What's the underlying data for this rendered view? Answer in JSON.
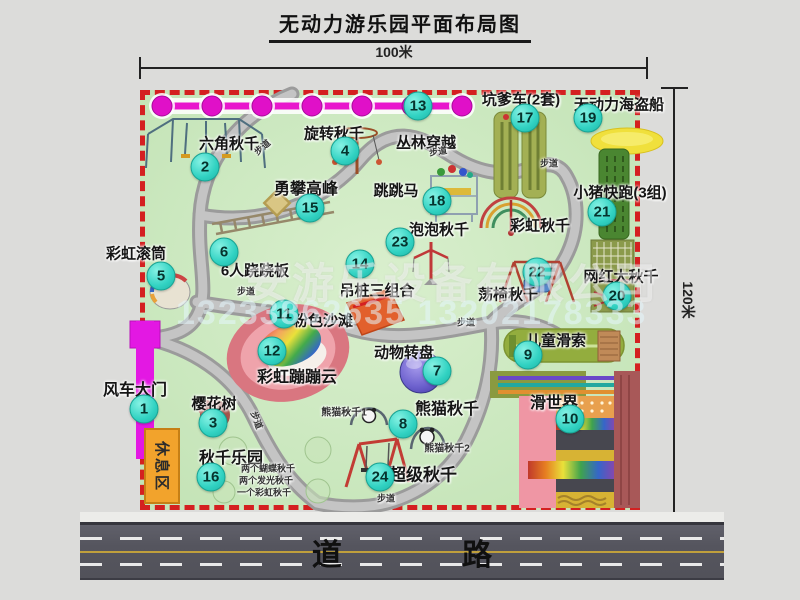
{
  "title": "无动力游乐园平面布局图",
  "dimensions": {
    "top": "100米",
    "right": "120米"
  },
  "road": {
    "label": "道 路"
  },
  "watermark": {
    "company": "安游乐设备有限公司",
    "phone": "13233862635 13202178333"
  },
  "rest_area": {
    "label": "休息区"
  },
  "items": [
    {
      "num": "1",
      "label": "风车大门",
      "lx": 135,
      "ly": 388,
      "cx": 144,
      "cy": 409,
      "ls": 16
    },
    {
      "num": "2",
      "label": "六角秋千",
      "lx": 229,
      "ly": 143,
      "cx": 205,
      "cy": 167
    },
    {
      "num": "3",
      "label": "樱花树",
      "lx": 214,
      "ly": 403,
      "cx": 213,
      "cy": 423
    },
    {
      "num": "4",
      "label": "旋转秋千",
      "lx": 334,
      "ly": 133,
      "cx": 345,
      "cy": 151
    },
    {
      "num": "5",
      "label": "彩虹滚筒",
      "lx": 136,
      "ly": 253,
      "cx": 161,
      "cy": 276
    },
    {
      "num": "6",
      "label": "6人跷跷板",
      "lx": 255,
      "ly": 270,
      "cx": 224,
      "cy": 252
    },
    {
      "num": "7",
      "label": "动物转盘",
      "lx": 404,
      "ly": 352,
      "cx": 437,
      "cy": 371
    },
    {
      "num": "8",
      "label": "熊猫秋千",
      "lx": 447,
      "ly": 407,
      "cx": 403,
      "cy": 424,
      "ls": 16
    },
    {
      "num": "9",
      "label": "儿童滑索",
      "lx": 556,
      "ly": 340,
      "cx": 528,
      "cy": 355
    },
    {
      "num": "10",
      "label": "滑世界",
      "lx": 554,
      "ly": 401,
      "cx": 570,
      "cy": 419,
      "ls": 16
    },
    {
      "num": "11",
      "label": "粉色沙滩",
      "lx": 323,
      "ly": 320,
      "cx": 284,
      "cy": 314
    },
    {
      "num": "12",
      "label": "彩虹蹦蹦云",
      "lx": 297,
      "ly": 375,
      "cx": 272,
      "cy": 351,
      "ls": 16
    },
    {
      "num": "13",
      "label": "丛林穿越",
      "lx": 426,
      "ly": 142,
      "cx": 418,
      "cy": 106
    },
    {
      "num": "14",
      "label": "吊桩三组合",
      "lx": 377,
      "ly": 290,
      "cx": 360,
      "cy": 264
    },
    {
      "num": "15",
      "label": "勇攀高峰",
      "lx": 306,
      "ly": 187,
      "cx": 310,
      "cy": 208,
      "ls": 16
    },
    {
      "num": "16",
      "label": "秋千乐园",
      "lx": 231,
      "ly": 456,
      "cx": 211,
      "cy": 477,
      "ls": 16
    },
    {
      "num": "17",
      "label": "坑爹车(2套)",
      "lx": 521,
      "ly": 99,
      "cx": 525,
      "cy": 118
    },
    {
      "num": "18",
      "label": "跳跳马",
      "lx": 396,
      "ly": 190,
      "cx": 437,
      "cy": 201
    },
    {
      "num": "19",
      "label": "无动力海盗船",
      "lx": 619,
      "ly": 104,
      "cx": 588,
      "cy": 118
    },
    {
      "num": "20",
      "label": "网红大秋千",
      "lx": 621,
      "ly": 276,
      "cx": 617,
      "cy": 296
    },
    {
      "num": "21",
      "label": "小猪快跑(3组)",
      "lx": 620,
      "ly": 192,
      "cx": 602,
      "cy": 212
    },
    {
      "num": "22",
      "label": "荡椅秋千",
      "lx": 508,
      "ly": 294,
      "cx": 537,
      "cy": 272
    },
    {
      "num": "23",
      "label": "泡泡秋千",
      "lx": 439,
      "ly": 229,
      "cx": 400,
      "cy": 242
    },
    {
      "num": "24",
      "label": "超级秋千",
      "lx": 423,
      "ly": 473,
      "cx": 380,
      "cy": 477,
      "ls": 17
    }
  ],
  "extra_labels": [
    {
      "text": "彩虹秋千",
      "x": 540,
      "y": 225,
      "size": 15,
      "name": "label-rainbow-swing"
    },
    {
      "text": "熊猫秋千1",
      "x": 344,
      "y": 411,
      "size": 10,
      "name": "label-panda-swing-1"
    },
    {
      "text": "熊猫秋千2",
      "x": 447,
      "y": 447,
      "size": 10,
      "name": "label-panda-swing-2"
    },
    {
      "text": "两个蝴蝶秋千",
      "x": 268,
      "y": 468,
      "size": 9,
      "name": "note-butterfly-swings"
    },
    {
      "text": "两个发光秋千",
      "x": 266,
      "y": 480,
      "size": 9,
      "name": "note-glow-swings"
    },
    {
      "text": "一个彩虹秋千",
      "x": 264,
      "y": 492,
      "size": 9,
      "name": "note-rainbow-swing"
    },
    {
      "text": "步道",
      "x": 262,
      "y": 147,
      "size": 9,
      "rot": -40,
      "name": "path-sign"
    },
    {
      "text": "步道",
      "x": 438,
      "y": 151,
      "size": 9,
      "rot": -8,
      "name": "path-sign"
    },
    {
      "text": "步道",
      "x": 549,
      "y": 163,
      "size": 9,
      "rot": 0,
      "name": "path-sign"
    },
    {
      "text": "步道",
      "x": 246,
      "y": 291,
      "size": 9,
      "rot": 0,
      "name": "path-sign"
    },
    {
      "text": "步道",
      "x": 466,
      "y": 322,
      "size": 9,
      "rot": 0,
      "name": "path-sign"
    },
    {
      "text": "步道",
      "x": 257,
      "y": 420,
      "size": 9,
      "rot": 70,
      "name": "path-sign"
    },
    {
      "text": "步道",
      "x": 386,
      "y": 498,
      "size": 9,
      "rot": 0,
      "name": "path-sign"
    }
  ]
}
